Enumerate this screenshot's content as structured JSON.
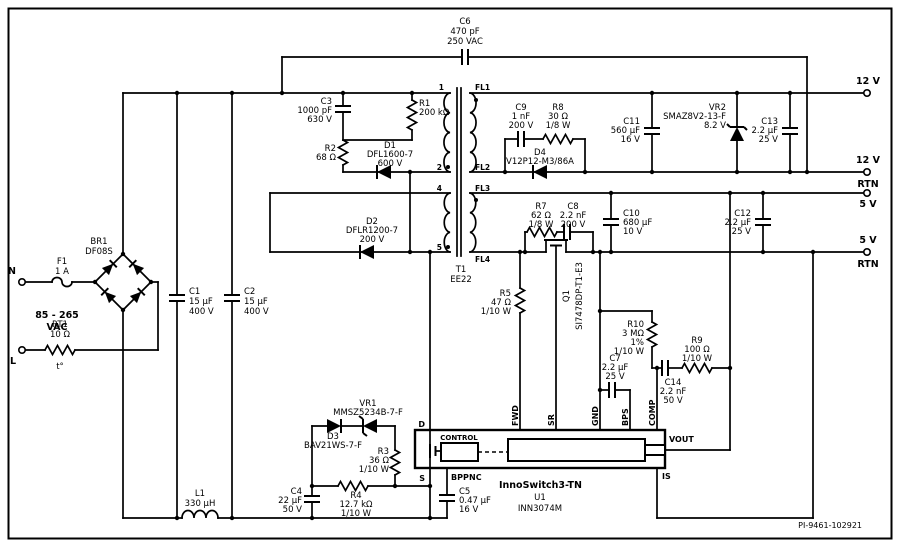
{
  "doc": {
    "code": "PI-9461-102921"
  },
  "input": {
    "n": "N",
    "l": "L",
    "range": "85 - 265",
    "unit": "VAC"
  },
  "terminals": {
    "t12": "12 V",
    "t12r1": "12 V",
    "t12r2": "RTN",
    "t5": "5 V",
    "t5r1": "5 V",
    "t5r2": "RTN"
  },
  "xfmr": {
    "ref": "T1",
    "core": "EE22",
    "p1": "1",
    "p2": "2",
    "p4": "4",
    "p5": "5",
    "fl1": "FL1",
    "fl2": "FL2",
    "fl3": "FL3",
    "fl4": "FL4"
  },
  "ic": {
    "name": "InnoSwitch3-TN",
    "ref": "U1",
    "part": "INN3074M",
    "control": "CONTROL",
    "pin_d": "D",
    "pin_s": "S",
    "pin_bpp": "BPP",
    "pin_nc": "NC",
    "pin_fwd": "FWD",
    "pin_sr": "SR",
    "pin_gnd": "GND",
    "pin_bps": "BPS",
    "pin_comp": "COMP",
    "pin_vout": "VOUT",
    "pin_is": "IS"
  },
  "parts": {
    "f1": {
      "l1": "F1",
      "l2": "1 A"
    },
    "rt1": {
      "l1": "RT1",
      "l2": "10 Ω",
      "l3": "t°"
    },
    "br1": {
      "l1": "BR1",
      "l2": "DF08S"
    },
    "c1": {
      "l1": "C1",
      "l2": "15 µF",
      "l3": "400 V"
    },
    "c2": {
      "l1": "C2",
      "l2": "15 µF",
      "l3": "400 V"
    },
    "l1": {
      "l1": "L1",
      "l2": "330 µH"
    },
    "c6": {
      "l1": "C6",
      "l2": "470 pF",
      "l3": "250 VAC"
    },
    "c3": {
      "l1": "C3",
      "l2": "1000 pF",
      "l3": "630 V"
    },
    "r1": {
      "l1": "R1",
      "l2": "200 kΩ"
    },
    "r2": {
      "l1": "R2",
      "l2": "68 Ω"
    },
    "d1": {
      "l1": "D1",
      "l2": "DFL1600-7",
      "l3": "600 V"
    },
    "d2": {
      "l1": "D2",
      "l2": "DFLR1200-7",
      "l3": "200 V"
    },
    "c9": {
      "l1": "C9",
      "l2": "1 nF",
      "l3": "200 V"
    },
    "r8": {
      "l1": "R8",
      "l2": "30 Ω",
      "l3": "1/8 W"
    },
    "d4": {
      "l1": "D4",
      "l2": "V12P12-M3/86A"
    },
    "c11": {
      "l1": "C11",
      "l2": "560 µF",
      "l3": "16 V"
    },
    "vr2": {
      "l1": "VR2",
      "l2": "SMAZ8V2-13-F",
      "l3": "8.2 V"
    },
    "c13": {
      "l1": "C13",
      "l2": "2.2 µF",
      "l3": "25 V"
    },
    "r7": {
      "l1": "R7",
      "l2": "62 Ω",
      "l3": "1/8 W"
    },
    "c8": {
      "l1": "C8",
      "l2": "2.2 nF",
      "l3": "200 V"
    },
    "c10": {
      "l1": "C10",
      "l2": "680 µF",
      "l3": "10 V"
    },
    "c12": {
      "l1": "C12",
      "l2": "2.2 µF",
      "l3": "25 V"
    },
    "q1": {
      "l1": "Q1",
      "l2": "SI7478DP-T1-E3"
    },
    "r5": {
      "l1": "R5",
      "l2": "47 Ω",
      "l3": "1/10 W"
    },
    "r10": {
      "l1": "R10",
      "l2": "3 MΩ",
      "l3": "1%",
      "l4": "1/10 W"
    },
    "r9": {
      "l1": "R9",
      "l2": "100 Ω",
      "l3": "1/10 W"
    },
    "c7": {
      "l1": "C7",
      "l2": "2.2 µF",
      "l3": "25 V"
    },
    "c14": {
      "l1": "C14",
      "l2": "2.2 nF",
      "l3": "50 V"
    },
    "vr1": {
      "l1": "VR1",
      "l2": "MMSZ5234B-7-F"
    },
    "d3": {
      "l1": "D3",
      "l2": "BAV21WS-7-F"
    },
    "r3": {
      "l1": "R3",
      "l2": "36 Ω",
      "l3": "1/10 W"
    },
    "c4": {
      "l1": "C4",
      "l2": "22 µF",
      "l3": "50 V"
    },
    "r4": {
      "l1": "R4",
      "l2": "12.7 kΩ",
      "l3": "1/10 W"
    },
    "c5": {
      "l1": "C5",
      "l2": "0.47 µF",
      "l3": "16 V"
    }
  }
}
